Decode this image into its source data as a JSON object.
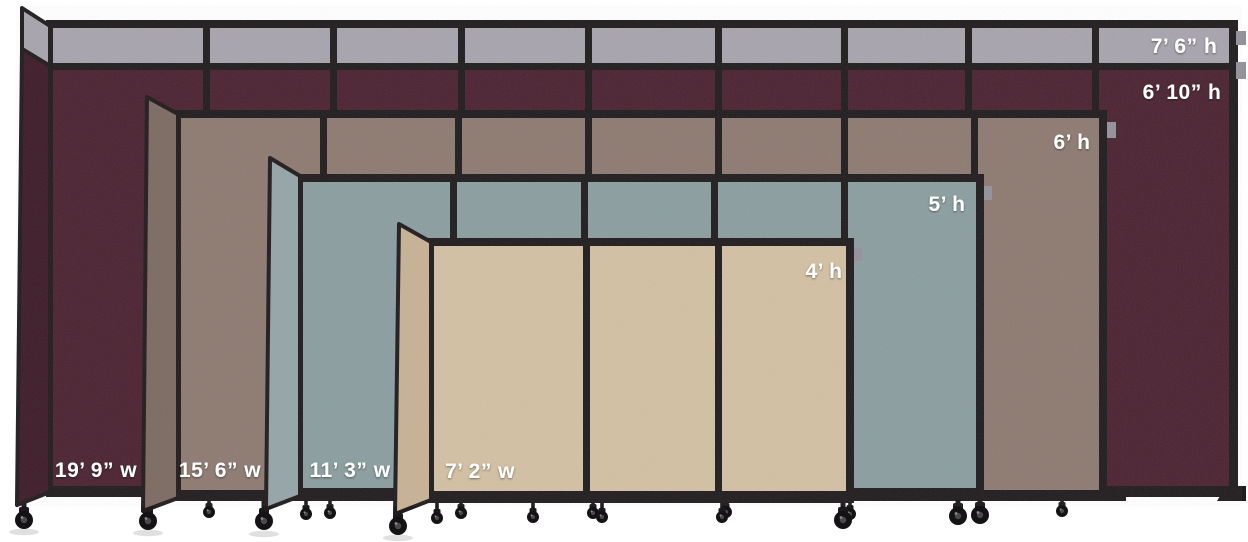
{
  "colors": {
    "background": "#ffffff",
    "frame_black": "#211d1f",
    "top_extension_gray": "#a7a4ad",
    "maroon": "#4c2332",
    "maroon_return": "#3f1c2a",
    "mocha": "#8e7b72",
    "mocha_return": "#7c6b62",
    "ocean": "#8b9ea0",
    "ocean_return": "#95a5a7",
    "sand": "#d3c0a3",
    "sand_return": "#c7b294",
    "hinge_gray": "#94919a",
    "label_text": "#ffffff"
  },
  "dividers": [
    {
      "fabric": "gray-top-extension",
      "height_label": "7’ 6” h"
    },
    {
      "fabric": "maroon",
      "height_label": "6’ 10” h",
      "width_label": "19’ 9” w"
    },
    {
      "fabric": "mocha-brown",
      "height_label": "6’ h",
      "width_label": "15’ 6” w"
    },
    {
      "fabric": "ocean-blue-gray",
      "height_label": "5’ h",
      "width_label": "11’ 3” w"
    },
    {
      "fabric": "sand-beige",
      "height_label": "4’ h",
      "width_label": "7’ 2” w"
    }
  ]
}
